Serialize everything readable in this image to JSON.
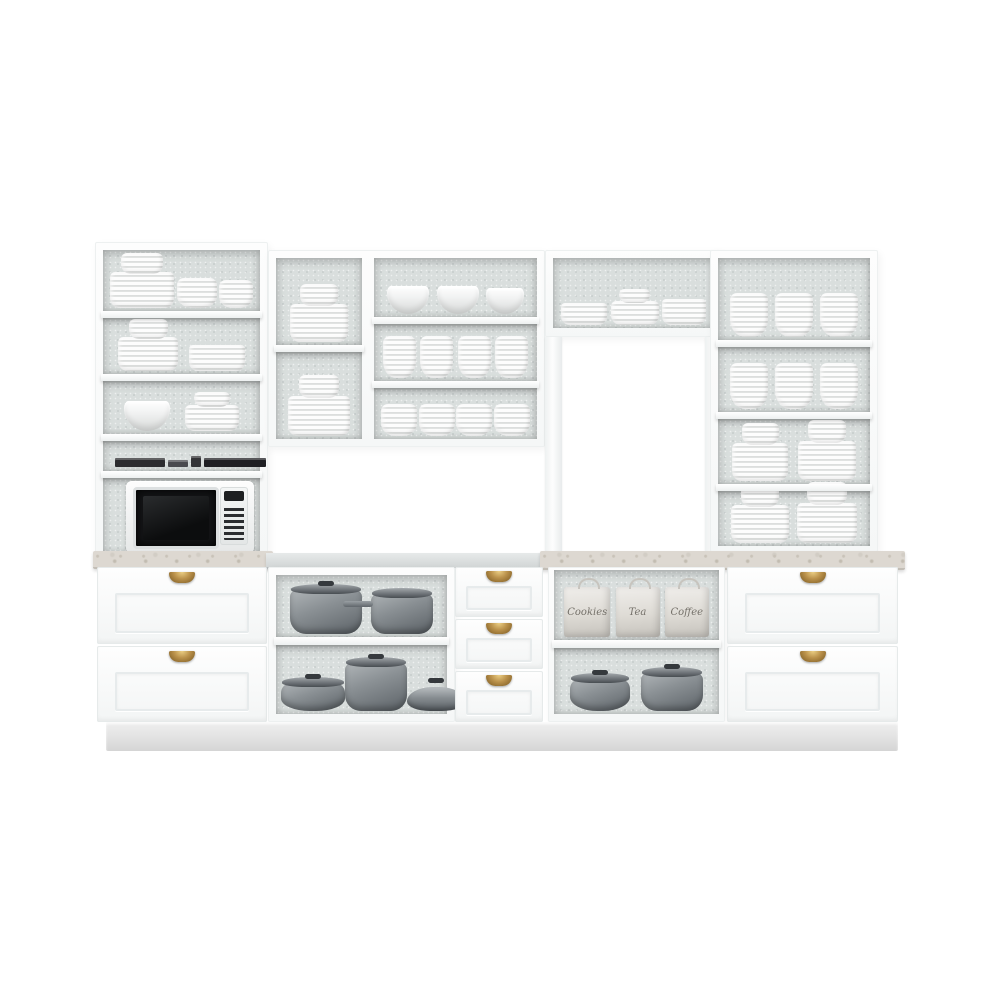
{
  "scene": {
    "description": "White modular kitchen cabinet set product photo on white background",
    "colors": {
      "cabinet_white": "#fbfcfc",
      "interior_gray": "#d9dedd",
      "marble_counter": "#ddd8d1",
      "cookware_gray": "#8b9195",
      "brass_handle": "#ba914b",
      "microwave_door": "#141517"
    }
  },
  "upper_left_cabinet": {
    "shelf1": [
      {
        "type": "combo",
        "w": 64,
        "h": 36
      },
      {
        "type": "bowl-stack",
        "w": 40,
        "h": 30
      },
      {
        "type": "bowl-stack",
        "w": 34,
        "h": 28
      }
    ],
    "shelf2": [
      {
        "type": "combo",
        "w": 60,
        "h": 34
      },
      {
        "type": "plate-stack",
        "w": 56,
        "h": 26
      }
    ],
    "shelf3": [
      {
        "type": "bowl",
        "w": 46,
        "h": 30
      },
      {
        "type": "combo",
        "w": 54,
        "h": 26
      }
    ],
    "shelf4_books": [
      {
        "type": "book",
        "w": 50,
        "h": 9,
        "color": "#2c2c2f"
      },
      {
        "type": "book",
        "w": 20,
        "h": 7,
        "color": "#4a4a4e"
      },
      {
        "type": "book",
        "w": 10,
        "h": 11,
        "color": "#343437"
      },
      {
        "type": "book",
        "w": 62,
        "h": 9,
        "color": "#1f1f23"
      }
    ]
  },
  "upper_middle_cabinet": {
    "left_top": [
      {
        "type": "combo",
        "w": 58,
        "h": 38
      }
    ],
    "left_bottom": [
      {
        "type": "combo",
        "w": 62,
        "h": 40
      }
    ],
    "right_top": [
      {
        "type": "bowl",
        "w": 42,
        "h": 28
      },
      {
        "type": "bowl",
        "w": 42,
        "h": 28
      },
      {
        "type": "bowl",
        "w": 38,
        "h": 26
      }
    ],
    "right_middle": [
      {
        "type": "bowl-stack",
        "w": 33,
        "h": 42
      },
      {
        "type": "bowl-stack",
        "w": 33,
        "h": 42
      },
      {
        "type": "bowl-stack",
        "w": 33,
        "h": 42
      },
      {
        "type": "bowl-stack",
        "w": 33,
        "h": 42
      }
    ],
    "right_bottom": [
      {
        "type": "bowl-stack",
        "w": 36,
        "h": 32
      },
      {
        "type": "bowl-stack",
        "w": 36,
        "h": 32
      },
      {
        "type": "bowl-stack",
        "w": 36,
        "h": 32
      },
      {
        "type": "bowl-stack",
        "w": 36,
        "h": 32
      }
    ]
  },
  "bridge_cabinet": {
    "shelf": [
      {
        "type": "plate-stack",
        "w": 46,
        "h": 22
      },
      {
        "type": "combo",
        "w": 48,
        "h": 24
      },
      {
        "type": "plate-stack",
        "w": 44,
        "h": 26
      }
    ]
  },
  "upper_right_cabinet": {
    "shelf1": [
      {
        "type": "bowl-stack",
        "w": 38,
        "h": 44
      },
      {
        "type": "bowl-stack",
        "w": 38,
        "h": 44
      },
      {
        "type": "bowl-stack",
        "w": 38,
        "h": 44
      }
    ],
    "shelf2": [
      {
        "type": "bowl-stack",
        "w": 38,
        "h": 46
      },
      {
        "type": "bowl-stack",
        "w": 38,
        "h": 46
      },
      {
        "type": "bowl-stack",
        "w": 38,
        "h": 46
      }
    ],
    "shelf3": [
      {
        "type": "combo",
        "w": 56,
        "h": 38
      },
      {
        "type": "combo",
        "w": 58,
        "h": 40
      }
    ],
    "shelf4": [
      {
        "type": "combo",
        "w": 58,
        "h": 38
      },
      {
        "type": "combo",
        "w": 60,
        "h": 40
      }
    ]
  },
  "base_middle_cabinet": {
    "top_shelf_pots": [
      {
        "type": "pot",
        "w": 72,
        "h": 44
      },
      {
        "type": "saucepan",
        "w": 62,
        "h": 40
      }
    ],
    "bottom_shelf_pots": [
      {
        "type": "lowpan",
        "w": 64,
        "h": 28
      },
      {
        "type": "pot",
        "w": 62,
        "h": 48
      },
      {
        "type": "panlid",
        "w": 58,
        "h": 24
      }
    ]
  },
  "base_right_open": {
    "canisters": [
      {
        "type": "canister",
        "w": 46,
        "h": 50,
        "label": "Cookies"
      },
      {
        "type": "canister",
        "w": 44,
        "h": 50,
        "label": "Tea"
      },
      {
        "type": "canister",
        "w": 44,
        "h": 50,
        "label": "Coffee"
      }
    ],
    "pots": [
      {
        "type": "lowpan",
        "w": 60,
        "h": 32
      },
      {
        "type": "pot",
        "w": 62,
        "h": 38
      }
    ]
  }
}
